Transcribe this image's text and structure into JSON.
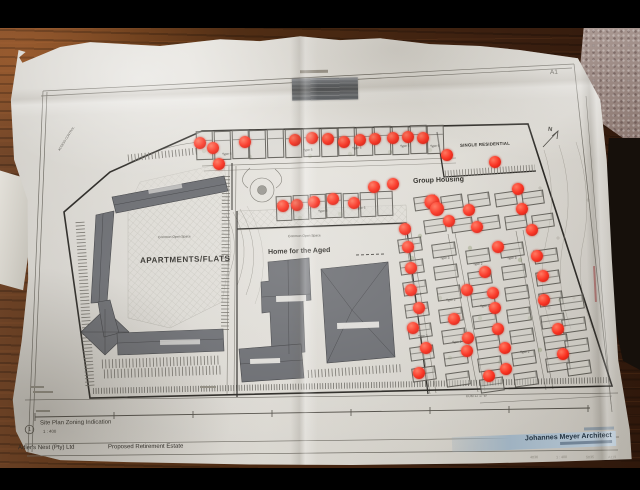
{
  "sheet": {
    "size_label": "A1",
    "north_letter": "N"
  },
  "title_block": {
    "sheet_bubble": "1",
    "drawing_title": "Site Plan Zoning Indication",
    "scale_text": "1 : 400",
    "client": "Adler's Nest (Pty) Ltd",
    "project": "Proposed Retirement Estate",
    "architect": "Johannes Meyer Architect",
    "ref_numbers": [
      "4036",
      "1 : 400",
      "5035",
      "A119"
    ]
  },
  "plan_labels": {
    "apartments": "APARTMENTS/FLATS",
    "home_for_the_aged": "Home for the Aged",
    "group_housing": "Group Housing",
    "single_residential": "SINGLE RESIDENTIAL",
    "access_control": "ACCESS CONTROL",
    "open_space_left": "Common Open Space",
    "open_space_mid": "Common Open Space",
    "boundary_bearing": "KOM 12 17 W"
  },
  "markers": {
    "color": "#f92b19",
    "positions": [
      [
        200,
        143
      ],
      [
        213,
        148
      ],
      [
        219,
        164
      ],
      [
        245,
        142
      ],
      [
        295,
        140
      ],
      [
        312,
        138
      ],
      [
        328,
        139
      ],
      [
        344,
        142
      ],
      [
        360,
        140
      ],
      [
        375,
        139
      ],
      [
        393,
        138
      ],
      [
        408,
        137
      ],
      [
        423,
        138
      ],
      [
        447,
        155
      ],
      [
        495,
        162
      ],
      [
        283,
        206
      ],
      [
        297,
        205
      ],
      [
        314,
        202
      ],
      [
        333,
        199
      ],
      [
        354,
        203
      ],
      [
        374,
        187
      ],
      [
        393,
        184
      ],
      [
        432,
        202,
        15
      ],
      [
        437,
        209,
        14
      ],
      [
        469,
        210
      ],
      [
        518,
        189
      ],
      [
        522,
        209
      ],
      [
        449,
        221
      ],
      [
        477,
        227
      ],
      [
        532,
        230
      ],
      [
        405,
        229
      ],
      [
        408,
        247
      ],
      [
        498,
        247
      ],
      [
        537,
        256
      ],
      [
        411,
        268
      ],
      [
        485,
        272
      ],
      [
        543,
        276
      ],
      [
        411,
        290
      ],
      [
        467,
        290
      ],
      [
        493,
        293
      ],
      [
        544,
        300
      ],
      [
        419,
        308
      ],
      [
        495,
        308
      ],
      [
        454,
        319
      ],
      [
        413,
        328
      ],
      [
        498,
        329
      ],
      [
        558,
        329
      ],
      [
        468,
        338
      ],
      [
        426,
        348
      ],
      [
        505,
        348
      ],
      [
        467,
        351
      ],
      [
        563,
        354
      ],
      [
        419,
        373
      ],
      [
        506,
        369
      ],
      [
        489,
        376
      ]
    ]
  },
  "units": {
    "top_strip": {
      "count": 14,
      "x": 196,
      "y": 131,
      "w": 17.8,
      "h": 29,
      "slope": -0.027,
      "rot": -1.5
    },
    "second_strip": {
      "count": 7,
      "x": 276,
      "y": 196,
      "w": 16.8,
      "h": 25,
      "slope": -0.05,
      "rot": -2
    },
    "cluster_rows": [
      {
        "count": 5,
        "x": 414,
        "y": 196,
        "pitch": 27,
        "w": 23,
        "h": 14,
        "slope": -0.05,
        "rot": -8
      },
      {
        "count": 5,
        "x": 424,
        "y": 219,
        "pitch": 27,
        "w": 23,
        "h": 14,
        "slope": -0.05,
        "rot": -8
      }
    ],
    "grid": {
      "unit_w": 24,
      "unit_h": 14,
      "row_pitch": 21.5,
      "row_drift": 2.4,
      "rot": -8,
      "cols": [
        {
          "x": 398,
          "y": 238,
          "n": 7
        },
        {
          "x": 432,
          "y": 243,
          "n": 7
        },
        {
          "x": 466,
          "y": 249,
          "n": 7
        },
        {
          "x": 500,
          "y": 243,
          "n": 7
        },
        {
          "x": 534,
          "y": 249,
          "n": 6
        },
        {
          "x": 560,
          "y": 296,
          "n": 4
        }
      ]
    },
    "type_labels": [
      [
        222,
        153,
        "Type 6"
      ],
      [
        303,
        149,
        "Type 5"
      ],
      [
        352,
        147,
        "Type 5"
      ],
      [
        400,
        145,
        "Type 5"
      ],
      [
        430,
        145,
        "Type 6"
      ],
      [
        318,
        210,
        "Type 6"
      ],
      [
        356,
        207,
        "Type 6"
      ],
      [
        440,
        257,
        "Type 3"
      ],
      [
        473,
        263,
        "Type 2"
      ],
      [
        507,
        257,
        "Type 3"
      ],
      [
        412,
        293,
        "Type 4"
      ],
      [
        446,
        299,
        "Type 2"
      ],
      [
        480,
        305,
        "Type 3"
      ],
      [
        418,
        335,
        "Type 3"
      ],
      [
        452,
        341,
        "Type 2"
      ],
      [
        520,
        351,
        "Type 2"
      ],
      [
        554,
        331,
        "Type 2"
      ]
    ]
  }
}
